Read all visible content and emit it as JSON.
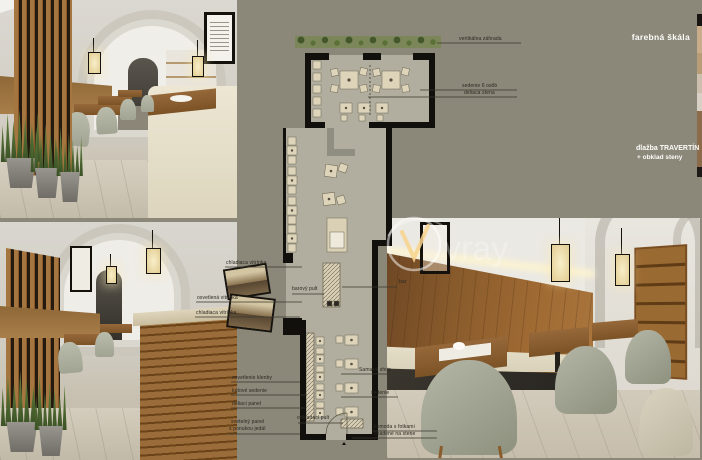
{
  "board": {
    "right_panel": {
      "color_scale_label": "farebná škála",
      "material_line1": "dlažba TRAVERTÍN",
      "material_line2": "+ obklad steny",
      "swatches": [
        {
          "color": "#171412",
          "h": 12
        },
        {
          "color": "#c9ad8a",
          "h": 27
        },
        {
          "color": "#b99d76",
          "h": 21
        },
        {
          "color": "#cdbfae",
          "h": 19
        },
        {
          "color": "#d8cfc5",
          "h": 18
        },
        {
          "color": "#8b6b4a",
          "h": 56
        },
        {
          "color": "#1d1a17",
          "h": 10
        }
      ]
    },
    "watermark": {
      "brand": "vray"
    },
    "plan": {
      "annotations_right": [
        {
          "text": "vertikálna záhrada"
        },
        {
          "text": "sedenie 6 osôb"
        },
        {
          "text": "deliaca stena"
        },
        {
          "text": "bar"
        },
        {
          "text": "Samural shop"
        },
        {
          "text": "sedenie"
        },
        {
          "text": "komoda s fotkami"
        },
        {
          "text": "osadené na stene"
        }
      ],
      "annotations_left": [
        {
          "text": "chladiaca vitrínka"
        },
        {
          "text": "osvetlená vitrínka"
        },
        {
          "text": "chladiaca vitrínka"
        },
        {
          "text": "osvetlenie klenby"
        },
        {
          "text": "kútové sedenie"
        },
        {
          "text": "deliaci panel"
        },
        {
          "text": "svetelný panel"
        },
        {
          "text": "s ponukou jedál"
        }
      ],
      "inline_labels": [
        {
          "text": "barový pult"
        },
        {
          "text": "odkladací pult"
        }
      ]
    },
    "colors": {
      "canvas_bg": "#8b8779",
      "plan_floor": "#b2ae9f",
      "wall": "#12100c",
      "wood": "#9a672f",
      "sage_chair": "#b0b2a2",
      "travertine": "#cdc5b5",
      "garden_green": "#7b8758",
      "annotation_ink": "#2b2921",
      "panel_text": "#fdfdfb"
    }
  }
}
